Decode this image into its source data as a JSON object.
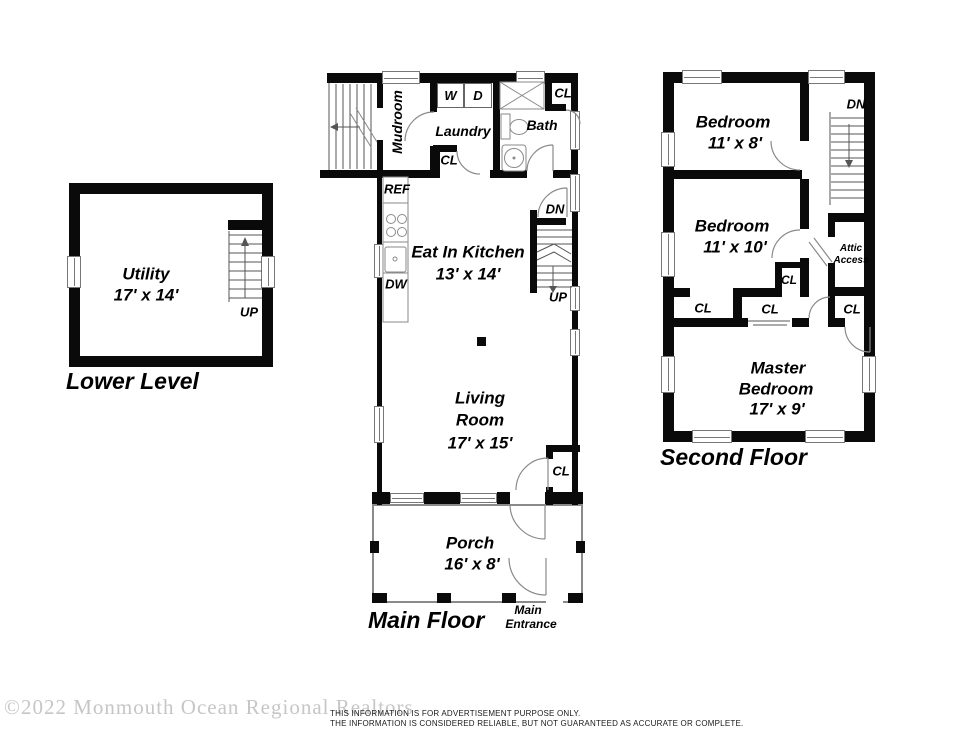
{
  "plans": {
    "lower_level": {
      "title": "Lower Level",
      "utility_name": "Utility",
      "utility_dims": "17' x 14'",
      "stairs_up": "UP"
    },
    "main_floor": {
      "title": "Main Floor",
      "mudroom": "Mudroom",
      "laundry": "Laundry",
      "washer": "W",
      "dryer": "D",
      "laundry_closet": "CL",
      "bath": "Bath",
      "bath_closet": "CL",
      "ref": "REF",
      "dishwasher": "DW",
      "kitchen_name": "Eat In Kitchen",
      "kitchen_dims": "13' x 14'",
      "stairs_down": "DN",
      "stairs_up": "UP",
      "living_line1": "Living",
      "living_line2": "Room",
      "living_dims": "17' x 15'",
      "living_closet": "CL",
      "porch_name": "Porch",
      "porch_dims": "16' x 8'",
      "entrance_line1": "Main",
      "entrance_line2": "Entrance"
    },
    "second_floor": {
      "title": "Second Floor",
      "bedroom1_name": "Bedroom",
      "bedroom1_dims": "11' x 8'",
      "bedroom2_name": "Bedroom",
      "bedroom2_dims": "11' x 10'",
      "stairs_down": "DN",
      "attic_line1": "Attic",
      "attic_line2": "Access",
      "closet_small": "CL",
      "closet_left": "CL",
      "closet_center": "CL",
      "closet_right": "CL",
      "master_line1": "Master",
      "master_line2": "Bedroom",
      "master_dims": "17' x 9'"
    }
  },
  "footer": {
    "watermark": "©2022 Monmouth Ocean Regional Realtors",
    "disclaimer_line1": "THIS INFORMATION IS FOR ADVERTISEMENT PURPOSE ONLY.",
    "disclaimer_line2": "THE INFORMATION IS CONSIDERED RELIABLE, BUT NOT GUARANTEED AS ACCURATE OR COMPLETE."
  },
  "colors": {
    "wall": "#0a0a0a",
    "fixture": "#8a8a8a",
    "watermark": "#c6c6c6",
    "background": "#ffffff"
  }
}
